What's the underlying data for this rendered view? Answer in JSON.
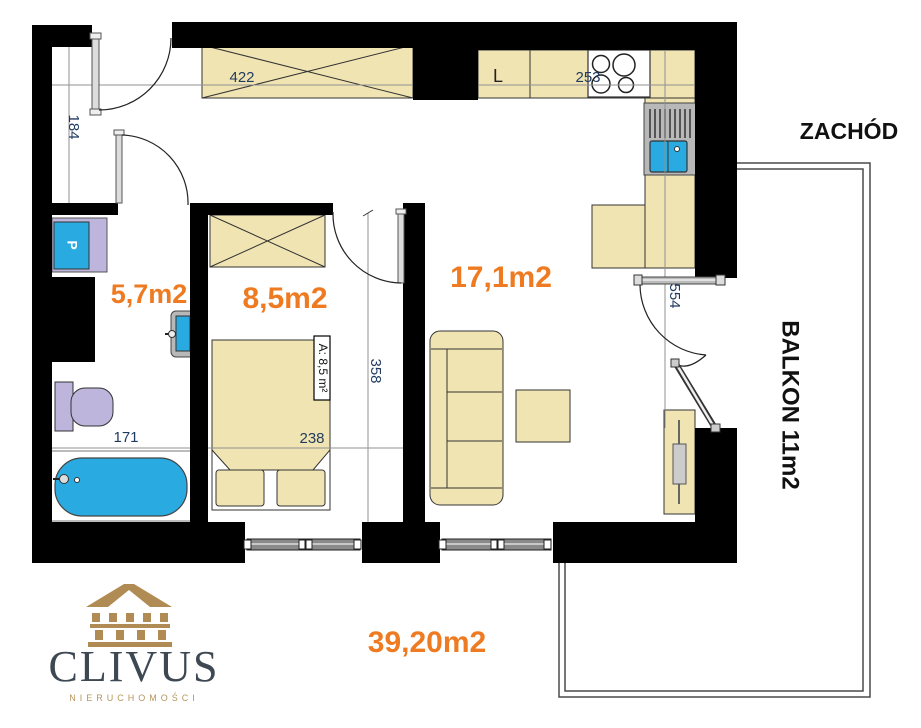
{
  "plan": {
    "compass_label": "ZACHÓD",
    "balcony_label": "BALKON 11m2",
    "rooms": {
      "bathroom_area": "5,7m2",
      "bedroom_area": "8,5m2",
      "living_area": "17,1m2",
      "total_area": "39,20m2"
    },
    "dimensions": {
      "hall_height": "184",
      "hall_width": "422",
      "kitchen_width": "253",
      "bedroom_depth": "358",
      "living_depth": "554",
      "bathroom_width": "171",
      "bedroom_width": "238",
      "bedroom_area_tag": "A: 8,5 m²"
    },
    "appliances": {
      "fridge_label": "L",
      "washer_label": "P"
    }
  },
  "logo": {
    "brand": "CLIVUS",
    "tagline": "NIERUCHOMOŚCI"
  },
  "colors": {
    "wall": "#000000",
    "furniture_tan": "#f1e4b3",
    "water_blue": "#29abe2",
    "sanitary_lavender": "#bdb5dc",
    "area_orange": "#ee7b22",
    "dim_navy": "#1f3a5f",
    "logo_gold": "#b5955e",
    "logo_slate": "#3d4852"
  }
}
